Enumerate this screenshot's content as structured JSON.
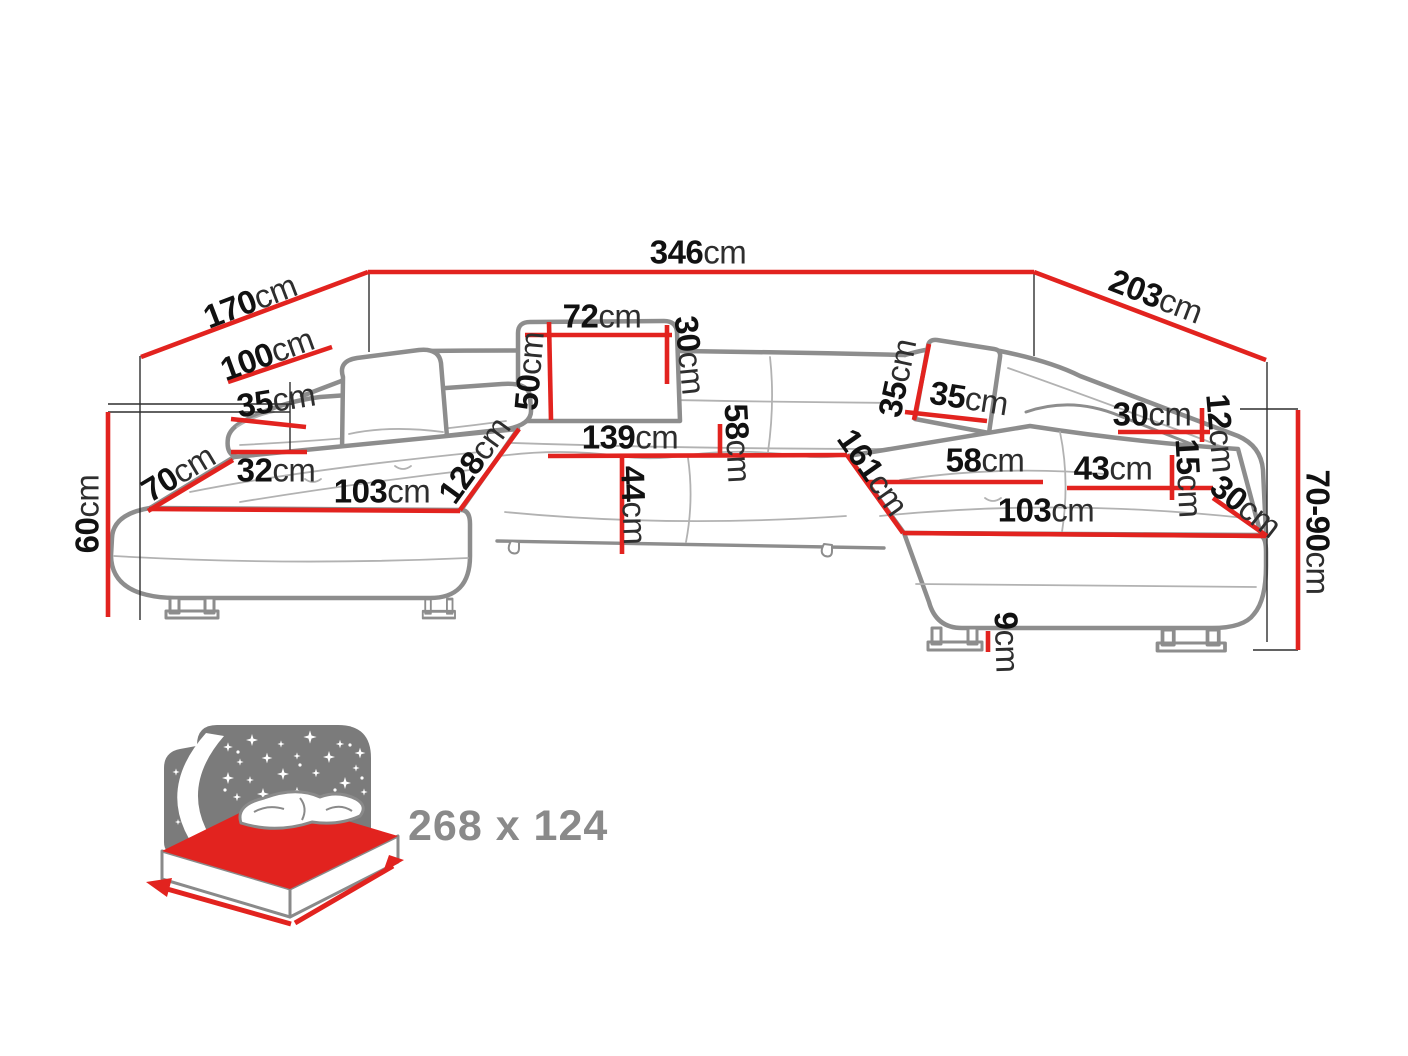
{
  "diagram_title": "U-shaped corner sofa dimensions",
  "colors": {
    "dimension_line": "#e2231f",
    "number_text": "#111111",
    "unit_text": "#2e2e2e",
    "sofa_outline": "#8d8d8d",
    "icon_panel": "#7b7b7b",
    "sleeping_label_text": "#8a8a8a"
  },
  "dimensions": [
    {
      "value": "346",
      "unit": "cm",
      "x": 698,
      "y": 252,
      "rot": 0
    },
    {
      "value": "170",
      "unit": "cm",
      "x": 250,
      "y": 301,
      "rot": -21
    },
    {
      "value": "203",
      "unit": "cm",
      "x": 1156,
      "y": 296,
      "rot": 21
    },
    {
      "value": "100",
      "unit": "cm",
      "x": 267,
      "y": 354,
      "rot": -20
    },
    {
      "value": "35",
      "unit": "cm",
      "x": 276,
      "y": 400,
      "rot": -9
    },
    {
      "value": "70",
      "unit": "cm",
      "x": 178,
      "y": 473,
      "rot": -31
    },
    {
      "value": "32",
      "unit": "cm",
      "x": 276,
      "y": 470,
      "rot": 0
    },
    {
      "value": "103",
      "unit": "cm",
      "x": 382,
      "y": 491,
      "rot": 0
    },
    {
      "value": "60",
      "unit": "cm",
      "x": 87,
      "y": 514,
      "rot": -90
    },
    {
      "value": "128",
      "unit": "cm",
      "x": 474,
      "y": 460,
      "rot": -54
    },
    {
      "value": "50",
      "unit": "cm",
      "x": 529,
      "y": 371,
      "rot": -85
    },
    {
      "value": "72",
      "unit": "cm",
      "x": 602,
      "y": 316,
      "rot": 0
    },
    {
      "value": "30",
      "unit": "cm",
      "x": 690,
      "y": 355,
      "rot": 84
    },
    {
      "value": "139",
      "unit": "cm",
      "x": 630,
      "y": 437,
      "rot": 0
    },
    {
      "value": "58",
      "unit": "cm",
      "x": 738,
      "y": 443,
      "rot": 87
    },
    {
      "value": "44",
      "unit": "cm",
      "x": 634,
      "y": 505,
      "rot": 88
    },
    {
      "value": "35",
      "unit": "cm",
      "x": 897,
      "y": 378,
      "rot": -78
    },
    {
      "value": "35",
      "unit": "cm",
      "x": 969,
      "y": 398,
      "rot": 9
    },
    {
      "value": "161",
      "unit": "cm",
      "x": 873,
      "y": 472,
      "rot": 55
    },
    {
      "value": "58",
      "unit": "cm",
      "x": 985,
      "y": 460,
      "rot": 0
    },
    {
      "value": "43",
      "unit": "cm",
      "x": 1113,
      "y": 468,
      "rot": 0
    },
    {
      "value": "103",
      "unit": "cm",
      "x": 1046,
      "y": 510,
      "rot": 0
    },
    {
      "value": "30",
      "unit": "cm",
      "x": 1152,
      "y": 414,
      "rot": 0
    },
    {
      "value": "12",
      "unit": "cm",
      "x": 1221,
      "y": 433,
      "rot": 85
    },
    {
      "value": "15",
      "unit": "cm",
      "x": 1189,
      "y": 478,
      "rot": 87
    },
    {
      "value": "30",
      "unit": "cm",
      "x": 1246,
      "y": 506,
      "rot": 38
    },
    {
      "value": "70-90",
      "unit": "cm",
      "x": 1318,
      "y": 532,
      "rot": 90
    },
    {
      "value": "9",
      "unit": "cm",
      "x": 1007,
      "y": 642,
      "rot": 88
    }
  ],
  "sleeping_area": {
    "label": "268 x 124"
  }
}
